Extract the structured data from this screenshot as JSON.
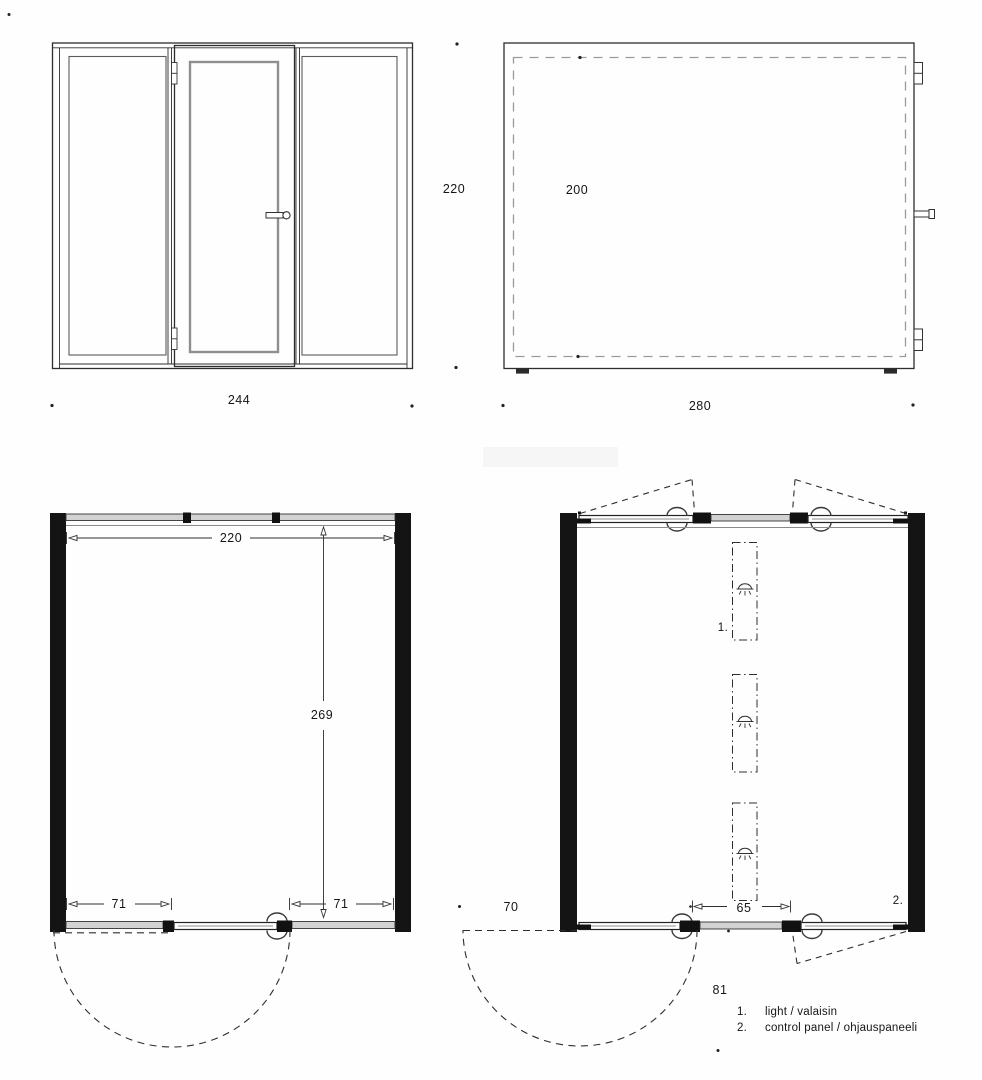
{
  "sheet": {
    "type": "architectural drawing set",
    "drawings": [
      "front elevation",
      "side elevation",
      "floor plan",
      "ceiling plan"
    ]
  },
  "labels": {
    "front_width": "244",
    "shared_height": "220",
    "side_inner": "200",
    "side_width": "280",
    "plan_width": "220",
    "plan_depth": "269",
    "plan_left_panel": "71",
    "plan_right_panel": "71",
    "ceiling_left": "70",
    "ceiling_center": "65",
    "ceiling_door": "81",
    "light_ref": "1.",
    "panel_ref": "2."
  },
  "legend": {
    "items": [
      {
        "num": "1.",
        "label": "light / valaisin"
      },
      {
        "num": "2.",
        "label": "control panel / ohjauspaneeli"
      }
    ]
  },
  "icons": {
    "downlight": "downlight-icon",
    "door_handle": "door-handle-icon",
    "hinge": "hinge-icon"
  },
  "colors": {
    "line": "#2e2e2e",
    "wall_fill": "#141414",
    "glass_fill": "#d2d2d2",
    "dashed": "#9a9a9a",
    "background": "#fefefe"
  }
}
